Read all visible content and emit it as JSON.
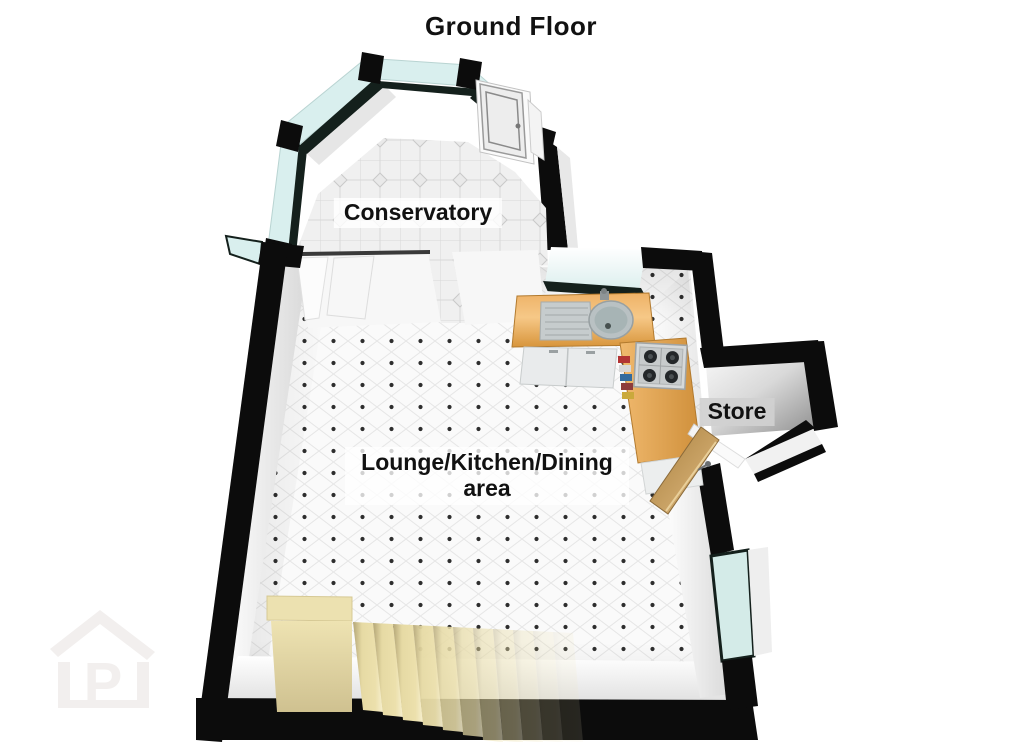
{
  "title": "Ground Floor",
  "rooms": {
    "conservatory": {
      "label": "Conservatory"
    },
    "lounge_kitchen_dining": {
      "label_line1": "Lounge/Kitchen/Dining",
      "label_line2": "area"
    },
    "store": {
      "label": "Store"
    }
  },
  "watermark": {
    "letter": "P"
  },
  "colors": {
    "wall_black": "#0c0c0c",
    "glass_cyan": "#d9efee",
    "dark_frame": "#14201c",
    "counter_wood": "#e8a855",
    "cabinet_white": "#e9ebec",
    "stairs_beige": "#e6daa4",
    "store_door_wood": "#c89b5f",
    "floor_white": "#fafafa",
    "tile_dot": "#2e2e2e",
    "label_text": "#111111",
    "watermark_gray": "#f2efee"
  }
}
